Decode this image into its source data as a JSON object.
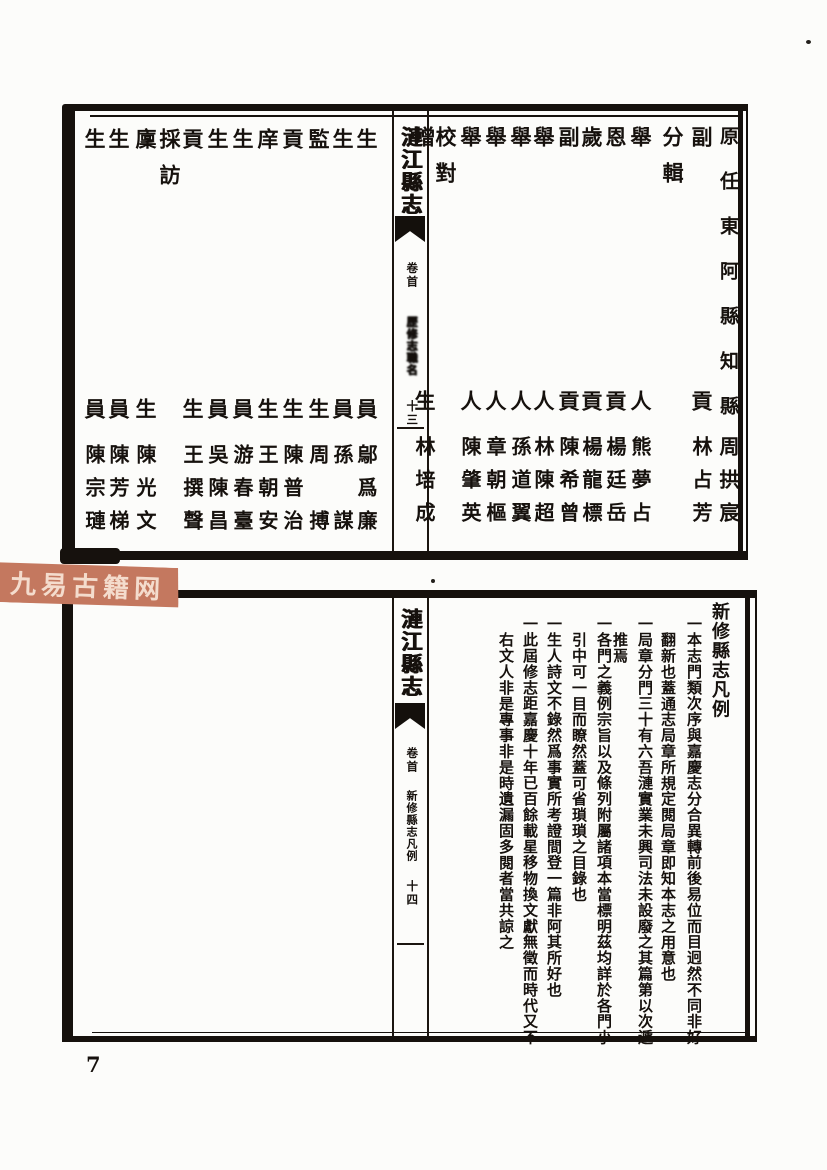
{
  "page": {
    "number": "7"
  },
  "watermark": {
    "text": "九易古籍网",
    "bg_color": "#c4785f",
    "text_color": "#f4dccd"
  },
  "top_frame": {
    "spine": {
      "title": "漣江縣志",
      "section": "卷首",
      "subsection": "歷修志職名",
      "page_label": "十三"
    },
    "right_page": {
      "columns": [
        {
          "role_top": "原任東阿縣知縣",
          "name": "周拱宸"
        },
        {
          "role_top": "副",
          "role_bottom": "貢",
          "name": "林占芳"
        },
        {
          "role_top": "分輯"
        },
        {
          "role_top": "舉",
          "role_bottom": "人",
          "name": "熊夢占"
        },
        {
          "role_top": "恩",
          "role_bottom": "貢",
          "name": "楊廷岳"
        },
        {
          "role_top": "歲",
          "role_bottom": "貢",
          "name": "楊龍標"
        },
        {
          "role_top": "副",
          "role_bottom": "貢",
          "name": "陳希曾"
        },
        {
          "role_top": "舉",
          "role_bottom": "人",
          "name": "林陳超"
        },
        {
          "role_top": "舉",
          "role_bottom": "人",
          "name": "孫道翼"
        },
        {
          "role_top": "舉",
          "role_bottom": "人",
          "name": "章朝樞"
        },
        {
          "role_top": "舉",
          "role_bottom": "人",
          "name": "陳肇英"
        },
        {
          "role_top": "校對"
        },
        {
          "role_top": "增",
          "role_bottom": "生",
          "name": "林培成"
        }
      ]
    },
    "left_page": {
      "columns": [
        {
          "role_top": "生",
          "role_bottom": "員",
          "name": "鄔爲廉"
        },
        {
          "role_top": "生",
          "role_bottom": "員",
          "name": "孫　謀"
        },
        {
          "role_top": "監",
          "role_bottom": "生",
          "name": "周　搏"
        },
        {
          "role_top": "貢",
          "role_bottom": "生",
          "name": "陳普治"
        },
        {
          "role_top": "庠",
          "role_bottom": "生",
          "name": "王朝安"
        },
        {
          "role_top": "生",
          "role_bottom": "員",
          "name": "游春臺"
        },
        {
          "role_top": "生",
          "role_bottom": "員",
          "name": "吳陳昌"
        },
        {
          "role_top": "貢",
          "role_bottom": "生",
          "name": "王撰聲"
        },
        {
          "role_top": "採訪"
        },
        {
          "role_top": "廩",
          "role_bottom": "生",
          "name": "陳光文"
        },
        {
          "role_top": "生",
          "role_bottom": "員",
          "name": "陳芳梯"
        },
        {
          "role_top": "生",
          "role_bottom": "員",
          "name": "陳宗璉"
        }
      ]
    }
  },
  "bottom_frame": {
    "spine": {
      "title": "漣江縣志",
      "section": "卷首",
      "subsection": "新修縣志凡例",
      "page_label": "十四"
    },
    "title": "新修縣志凡例",
    "columns": [
      {
        "text": "一本志門類次序與嘉慶志分合異轉前後易位而目迥然不同非好"
      },
      {
        "text": "翻新也蓋通志局章所規定閱局章即知本志之用意也"
      },
      {
        "text": "一局章分門三十有六吾漣實業未興司法未設廢之其篇第以次遞"
      },
      {
        "text": "推焉"
      },
      {
        "text": "一各門之義例宗旨以及條列附屬諸項本當標明茲均詳於各門小"
      },
      {
        "text": "引中可一目而瞭然蓋可省瑣瑣之目錄也"
      },
      {
        "text": "一生人詩文不錄然爲事實所考證間登一篇非阿其所好也"
      },
      {
        "text": "一此屆修志距嘉慶十年已百餘載星移物換文獻無徵而時代又不"
      },
      {
        "text": "右文人非是專事非是時遺漏固多閱者當共諒之"
      }
    ]
  }
}
